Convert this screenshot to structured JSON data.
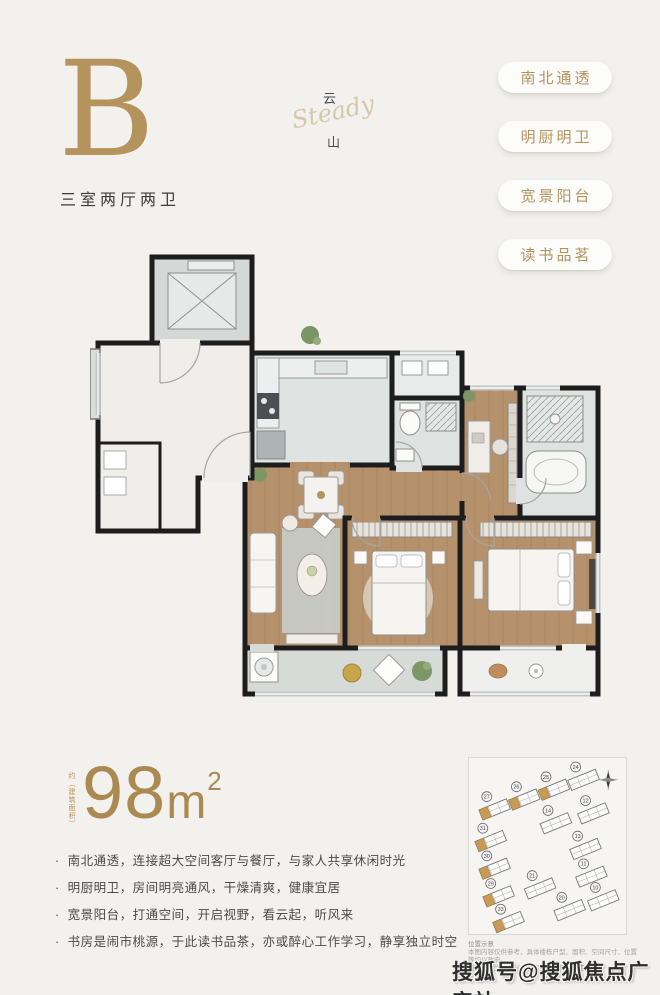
{
  "header": {
    "unit_letter": "B",
    "unit_type": "三室两厅两卫",
    "logo_top": "云",
    "logo_script": "Steady",
    "logo_bottom": "山",
    "badges": [
      "南北通透",
      "明厨明卫",
      "宽景阳台",
      "读书品茗"
    ]
  },
  "area": {
    "note": "约（建筑面积）",
    "value": "98",
    "unit": "m",
    "sup": "2"
  },
  "features": {
    "bullet_char": "·",
    "items": [
      "南北通透，连接超大空间客厅与餐厅，与家人共享休闲时光",
      "明厨明卫，房间明亮通风，干燥清爽，健康宜居",
      "宽景阳台，打通空间，开启视野，看云起，听风来",
      "书房是闹市桃源，于此读书品茶，亦或醉心工作学习，静享独立时空"
    ]
  },
  "siteplan": {
    "caption_title": "位置示意",
    "caption_lines": [
      "本图内容仅供参考，具体楼栋户型、面积、空间尺寸、位置等均以政府",
      "最终审批文件及《商品房买卖合同》约定为准。"
    ],
    "buildings": [
      {
        "no": "27",
        "x": 26,
        "y": 52,
        "highlight": true
      },
      {
        "no": "26",
        "x": 56,
        "y": 42,
        "highlight": true
      },
      {
        "no": "25",
        "x": 86,
        "y": 32,
        "highlight": true
      },
      {
        "no": "24",
        "x": 116,
        "y": 22,
        "highlight": false
      },
      {
        "no": "31",
        "x": 22,
        "y": 84,
        "highlight": true
      },
      {
        "no": "14",
        "x": 88,
        "y": 66,
        "highlight": false
      },
      {
        "no": "12",
        "x": 126,
        "y": 56,
        "highlight": false
      },
      {
        "no": "30",
        "x": 26,
        "y": 112,
        "highlight": true
      },
      {
        "no": "13",
        "x": 118,
        "y": 92,
        "highlight": false
      },
      {
        "no": "29",
        "x": 30,
        "y": 140,
        "highlight": true
      },
      {
        "no": "21",
        "x": 72,
        "y": 132,
        "highlight": false
      },
      {
        "no": "11",
        "x": 124,
        "y": 120,
        "highlight": false
      },
      {
        "no": "33",
        "x": 40,
        "y": 166,
        "highlight": true
      },
      {
        "no": "20",
        "x": 102,
        "y": 154,
        "highlight": false
      },
      {
        "no": "10",
        "x": 136,
        "y": 144,
        "highlight": false
      }
    ]
  },
  "watermark": "搜狐号@搜狐焦点广安站",
  "colors": {
    "gold": "#b5935c",
    "wall": "#1d1d1d",
    "wood": "#b6926c",
    "tile": "#dfe3e1",
    "background": "#f2f1ee"
  }
}
